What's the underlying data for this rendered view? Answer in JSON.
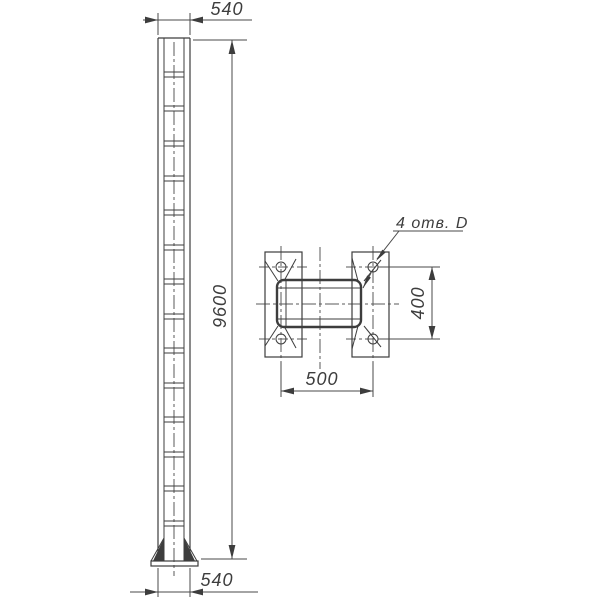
{
  "labels": {
    "dim_top_width": "540",
    "dim_bottom_width": "540",
    "dim_height": "9600",
    "dim_plan_width": "500",
    "dim_plan_holes_vertical": "400",
    "holes_note": "4 отв. D"
  },
  "drawing": {
    "background": "#ffffff",
    "line_color": "#3d3d3d",
    "dim_color": "#4a4a4a",
    "centerline_color": "#5a5a5a",
    "column": {
      "batten_ys": [
        72,
        106,
        141,
        176,
        210,
        245,
        279,
        314,
        348,
        383,
        417,
        452,
        486,
        521
      ]
    },
    "plan": {
      "hole_count": 4
    }
  }
}
